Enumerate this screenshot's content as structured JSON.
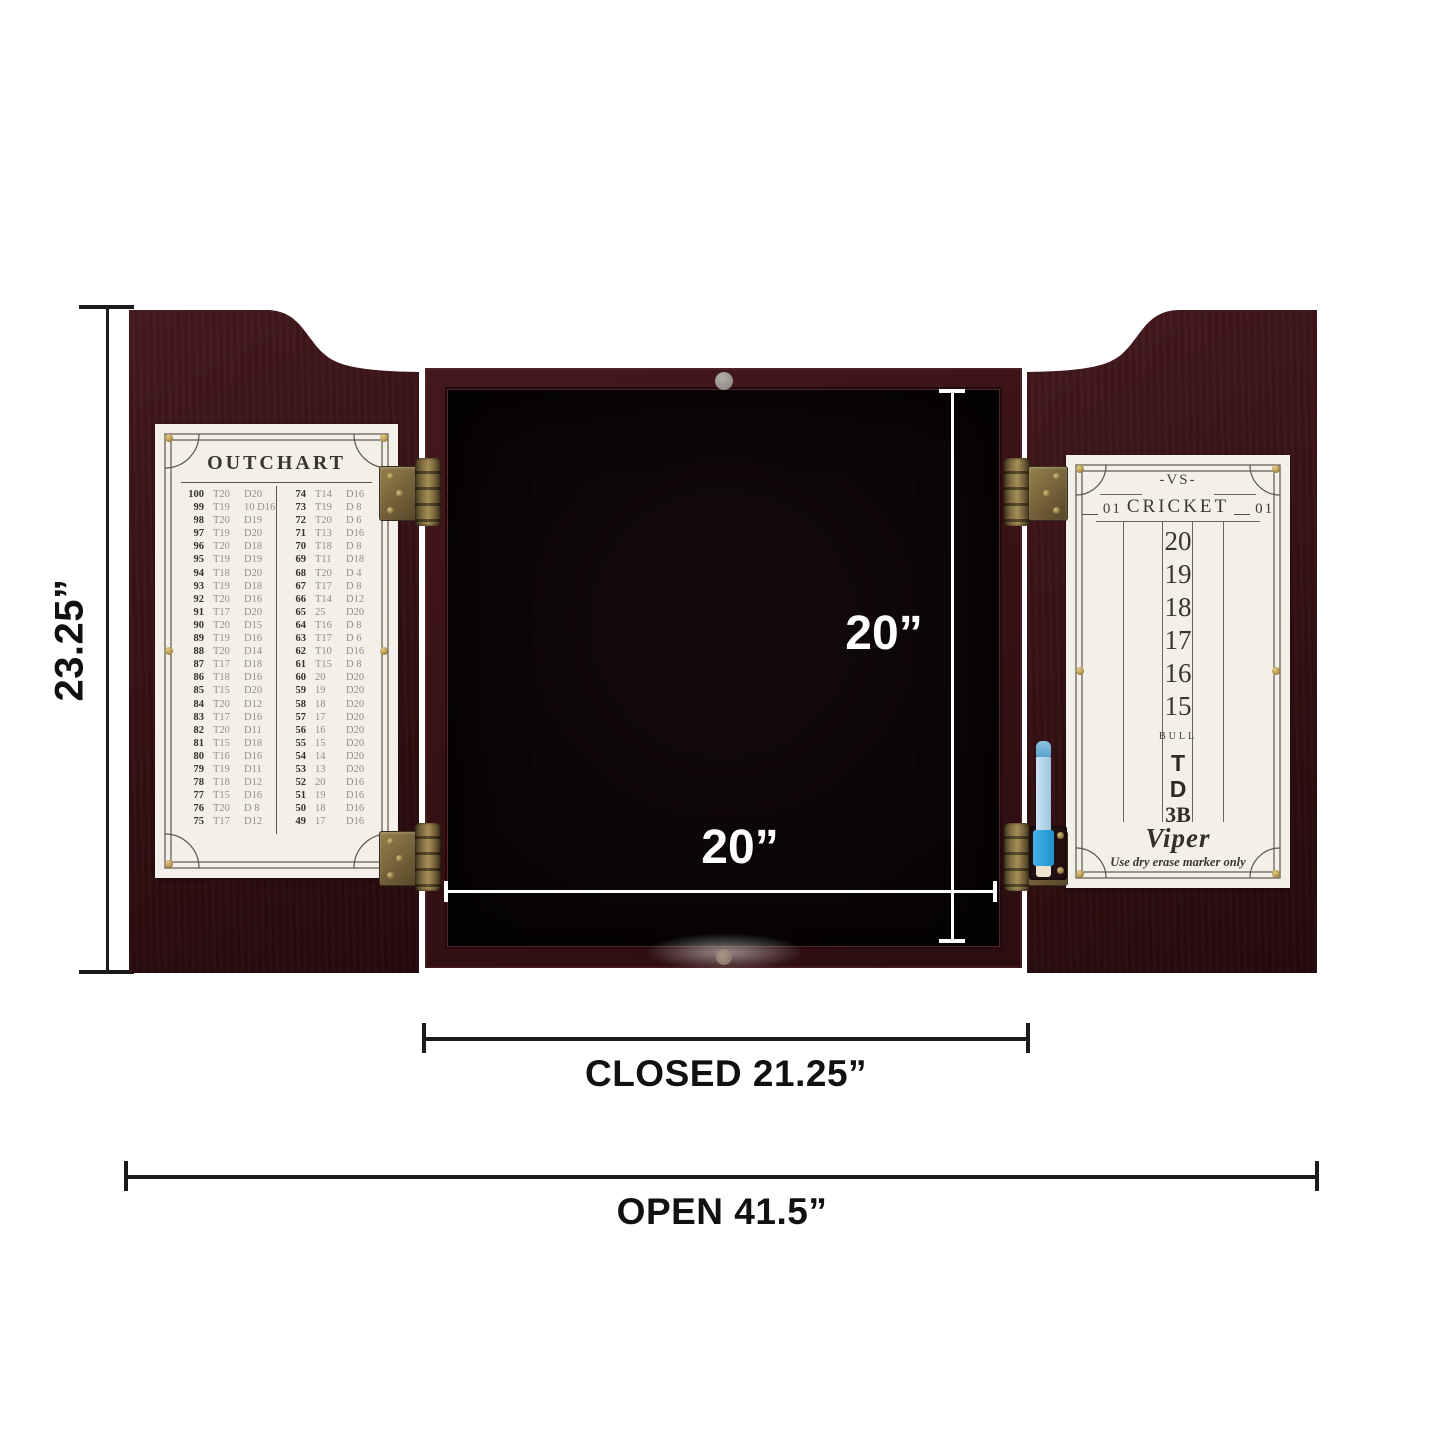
{
  "dimension_labels": {
    "height": "23.25”",
    "inner_height": "20”",
    "inner_width": "20”",
    "closed": "CLOSED 21.25”",
    "open": "OPEN 41.5”"
  },
  "outchart_card": {
    "title": "OUTCHART",
    "columns": [
      {
        "rows": [
          [
            "100",
            "T20",
            "D20"
          ],
          [
            "99",
            "T19",
            "10 D16"
          ],
          [
            "98",
            "T20",
            "D19"
          ],
          [
            "97",
            "T19",
            "D20"
          ],
          [
            "96",
            "T20",
            "D18"
          ],
          [
            "95",
            "T19",
            "D19"
          ],
          [
            "94",
            "T18",
            "D20"
          ],
          [
            "93",
            "T19",
            "D18"
          ],
          [
            "92",
            "T20",
            "D16"
          ],
          [
            "91",
            "T17",
            "D20"
          ],
          [
            "90",
            "T20",
            "D15"
          ],
          [
            "89",
            "T19",
            "D16"
          ],
          [
            "88",
            "T20",
            "D14"
          ],
          [
            "87",
            "T17",
            "D18"
          ],
          [
            "86",
            "T18",
            "D16"
          ],
          [
            "85",
            "T15",
            "D20"
          ],
          [
            "84",
            "T20",
            "D12"
          ],
          [
            "83",
            "T17",
            "D16"
          ],
          [
            "82",
            "T20",
            "D11"
          ],
          [
            "81",
            "T15",
            "D18"
          ],
          [
            "80",
            "T16",
            "D16"
          ],
          [
            "79",
            "T19",
            "D11"
          ],
          [
            "78",
            "T18",
            "D12"
          ],
          [
            "77",
            "T15",
            "D16"
          ],
          [
            "76",
            "T20",
            "D 8"
          ],
          [
            "75",
            "T17",
            "D12"
          ]
        ]
      },
      {
        "rows": [
          [
            "74",
            "T14",
            "D16"
          ],
          [
            "73",
            "T19",
            "D 8"
          ],
          [
            "72",
            "T20",
            "D 6"
          ],
          [
            "71",
            "T13",
            "D16"
          ],
          [
            "70",
            "T18",
            "D 8"
          ],
          [
            "69",
            "T11",
            "D18"
          ],
          [
            "68",
            "T20",
            "D 4"
          ],
          [
            "67",
            "T17",
            "D 8"
          ],
          [
            "66",
            "T14",
            "D12"
          ],
          [
            "65",
            "25",
            "D20"
          ],
          [
            "64",
            "T16",
            "D 8"
          ],
          [
            "63",
            "T17",
            "D 6"
          ],
          [
            "62",
            "T10",
            "D16"
          ],
          [
            "61",
            "T15",
            "D 8"
          ],
          [
            "60",
            "20",
            "D20"
          ],
          [
            "59",
            "19",
            "D20"
          ],
          [
            "58",
            "18",
            "D20"
          ],
          [
            "57",
            "17",
            "D20"
          ],
          [
            "56",
            "16",
            "D20"
          ],
          [
            "55",
            "15",
            "D20"
          ],
          [
            "54",
            "14",
            "D20"
          ],
          [
            "53",
            "13",
            "D20"
          ],
          [
            "52",
            "20",
            "D16"
          ],
          [
            "51",
            "19",
            "D16"
          ],
          [
            "50",
            "18",
            "D16"
          ],
          [
            "49",
            "17",
            "D16"
          ]
        ]
      }
    ]
  },
  "cricket_card": {
    "vs": "-VS-",
    "header": {
      "left_score": "01",
      "title": "CRICKET",
      "right_score": "01"
    },
    "targets": [
      {
        "label": "20",
        "style": "num"
      },
      {
        "label": "19",
        "style": "num"
      },
      {
        "label": "18",
        "style": "num"
      },
      {
        "label": "17",
        "style": "num"
      },
      {
        "label": "16",
        "style": "num"
      },
      {
        "label": "15",
        "style": "num"
      },
      {
        "label": "BULL",
        "style": "bull"
      },
      {
        "label": "T",
        "style": "letter"
      },
      {
        "label": "D",
        "style": "letter"
      },
      {
        "label": "3B",
        "style": "letter3b"
      }
    ],
    "brand": "Viper",
    "note": "Use dry erase marker only"
  },
  "colors": {
    "wood": "#3a1316",
    "wood_dark": "#2a0c0f",
    "interior_black": "#0b0507",
    "card_bg": "#f3f0e9",
    "card_line": "#5a5348",
    "brass": "#8a7547",
    "pen_body": "#b2d4ea",
    "pen_accent": "#2aa4de",
    "dimension_black": "#1b1b1b",
    "dimension_white": "#ffffff"
  }
}
